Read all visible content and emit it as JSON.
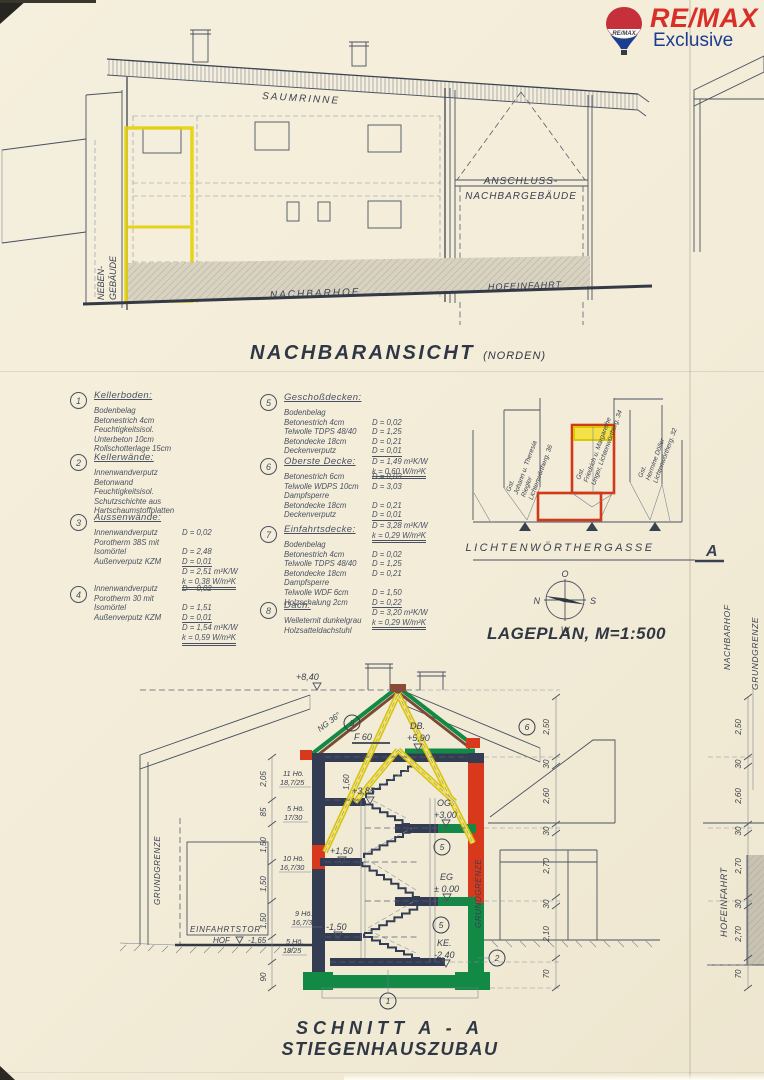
{
  "logo": {
    "brand": "RE/MAX",
    "sub": "Exclusive",
    "balloon_text": "RE/MAX"
  },
  "elevation": {
    "title": "NACHBARANSICHT",
    "title_suffix": "(NORDEN)",
    "labels": {
      "saumrinne": "SAUMRINNE",
      "anschluss1": "ANSCHLUSS-",
      "anschluss2": "NACHBARGEBÄUDE",
      "neben1": "NEBEN-",
      "neben2": "GEBÄUDE",
      "nachbarhof": "NACHBARHOF",
      "hofeinfahrt": "HOFEINFAHRT"
    }
  },
  "legend": {
    "items": [
      {
        "num": "1",
        "title": "Kellerboden:",
        "lines": [
          {
            "l": "Bodenbelag",
            "r": ""
          },
          {
            "l": "Betonestrich 4cm",
            "r": ""
          },
          {
            "l": "Feuchtigkeitsisol.",
            "r": ""
          },
          {
            "l": "Unterbeton 10cm",
            "r": ""
          },
          {
            "l": "Rollschotterlage 15cm",
            "r": ""
          }
        ]
      },
      {
        "num": "2",
        "title": "Kellerwände:",
        "lines": [
          {
            "l": "Innenwandverputz",
            "r": ""
          },
          {
            "l": "Betonwand",
            "r": ""
          },
          {
            "l": "Feuchtigkeitsisol.",
            "r": ""
          },
          {
            "l": "Schutzschichte aus",
            "r": ""
          },
          {
            "l": "Hartschaumstoffplatten",
            "r": ""
          }
        ]
      },
      {
        "num": "3",
        "title": "Aussenwände:",
        "lines": [
          {
            "l": "Innenwandverputz",
            "r": "D = 0,02"
          },
          {
            "l": "Porotherm 38S mit",
            "r": ""
          },
          {
            "l": "Isomörtel",
            "r": "D = 2,48"
          },
          {
            "l": "Außenverputz KZM",
            "r": "D = 0,01",
            "u": 1
          },
          {
            "l": "",
            "r": "D = 2,51 m²K/W"
          },
          {
            "l": "",
            "r": "k = 0,38 W/m²K",
            "u": 2
          }
        ]
      },
      {
        "num": "4",
        "title": "",
        "lines": [
          {
            "l": "Innenwandverputz",
            "r": "D = 0,02"
          },
          {
            "l": "Porotherm 30 mit",
            "r": ""
          },
          {
            "l": "Isomörtel",
            "r": "D = 1,51"
          },
          {
            "l": "Außenverputz KZM",
            "r": "D = 0,01",
            "u": 1
          },
          {
            "l": "",
            "r": "D = 1,54 m²K/W"
          },
          {
            "l": "",
            "r": "k = 0,59 W/m²K",
            "u": 2
          }
        ]
      },
      {
        "num": "5",
        "title": "Geschoßdecken:",
        "lines": [
          {
            "l": "Bodenbelag",
            "r": ""
          },
          {
            "l": "Betonestrich 4cm",
            "r": "D = 0,02"
          },
          {
            "l": "Telwolle TDPS 48/40",
            "r": "D = 1,25"
          },
          {
            "l": "Betondecke 18cm",
            "r": "D = 0,21"
          },
          {
            "l": "Deckenverputz",
            "r": "D = 0,01",
            "u": 1
          },
          {
            "l": "",
            "r": "D = 1,49 m²K/W"
          },
          {
            "l": "",
            "r": "k = 0,60 W/m²K",
            "u": 2
          }
        ]
      },
      {
        "num": "6",
        "title": "Oberste Decke:",
        "lines": [
          {
            "l": "Betonestrich 6cm",
            "r": "D = 0,03"
          },
          {
            "l": "Telwolle WDPS 10cm",
            "r": "D = 3,03"
          },
          {
            "l": "Dampfsperre",
            "r": ""
          },
          {
            "l": "Betondecke 18cm",
            "r": "D = 0,21"
          },
          {
            "l": "Deckenverputz",
            "r": "D = 0,01",
            "u": 1
          },
          {
            "l": "",
            "r": "D = 3,28 m²K/W"
          },
          {
            "l": "",
            "r": "k = 0,29 W/m²K",
            "u": 2
          }
        ]
      },
      {
        "num": "7",
        "title": "Einfahrtsdecke:",
        "lines": [
          {
            "l": "Bodenbelag",
            "r": ""
          },
          {
            "l": "Betonestrich 4cm",
            "r": "D = 0,02"
          },
          {
            "l": "Telwolle TDPS 48/40",
            "r": "D = 1,25"
          },
          {
            "l": "Betondecke 18cm",
            "r": "D = 0,21"
          },
          {
            "l": "Dampfsperre",
            "r": ""
          },
          {
            "l": "Telwolle WDF 6cm",
            "r": "D = 1,50"
          },
          {
            "l": "Holzschalung 2cm",
            "r": "D = 0,22",
            "u": 1
          },
          {
            "l": "",
            "r": "D = 3,20 m²K/W"
          },
          {
            "l": "",
            "r": "k = 0,29 W/m²K",
            "u": 2
          }
        ]
      },
      {
        "num": "8",
        "title": "Dach:",
        "lines": [
          {
            "l": "Welleternit dunkelgrau",
            "r": ""
          },
          {
            "l": "Holzsatteldachstuhl",
            "r": ""
          }
        ]
      }
    ]
  },
  "siteplan": {
    "title": "LAGEPLAN, M=1:500",
    "street": "LICHTENWÖRTHERGASSE",
    "marker": "A",
    "compass": {
      "top": "O",
      "left": "N",
      "right": "S",
      "bottom": "W"
    },
    "parcels": [
      {
        "rows": [
          "Gst.",
          "Johann u. Theresia",
          "Riegler",
          "Lichtenwörtherg. 36"
        ]
      },
      {
        "rows": [
          "Gst.",
          "Friedrich u. Margarethe",
          "Unger, Lichtenwörtherg. 34"
        ]
      },
      {
        "rows": [
          "Gst.",
          "Hermine Döller",
          "Lichtenwörtherg. 32"
        ]
      }
    ]
  },
  "section": {
    "title1": "SCHNITT  A - A",
    "title2": "STIEGENHAUSZUBAU",
    "levels": {
      "ridge": "+8,40",
      "db_label": "DB.",
      "db": "+5,90",
      "p385": "+3,85",
      "og_label": "OG.",
      "og": "+3,00",
      "p150": "+1,50",
      "eg_label": "EG",
      "eg": "± 0.00",
      "m150": "-1,50",
      "ke_label": "KE.",
      "ke": "-2,40",
      "einfahrtstor": "EINFAHRTSTOR",
      "hof_label": "HOF",
      "hof": "-1,65"
    },
    "roof_pitch": "NG 36°",
    "f60": "F 60",
    "dim160": "1,60",
    "stair_notes": [
      {
        "a": "11 Hö.",
        "b": "18,7/25"
      },
      {
        "a": "5 Hö.",
        "b": "17/30"
      },
      {
        "a": "10 Hö.",
        "b": "16,7/30"
      },
      {
        "a": "9 Hö.",
        "b": "16,7/30"
      },
      {
        "a": "5 Hö.",
        "b": "18/25"
      }
    ],
    "left_dims": [
      "2,05",
      "85",
      "1,50",
      "1,50",
      "1,50",
      "90"
    ],
    "mid_dims": [
      "2,50",
      "30",
      "2,60",
      "30",
      "2,70",
      "30",
      "2,10",
      "70"
    ],
    "right_dims": [
      "2,50",
      "30",
      "2,60",
      "30",
      "2,70",
      "30",
      "2,70",
      "70"
    ],
    "grundgrenze": "GRUNDGRENZE",
    "nachbarhof": "NACHBARHOF",
    "hofeinfahrt": "HOFEINFAHRT",
    "circles": {
      "c1": "1",
      "c2": "2",
      "c5": "5",
      "c6": "6",
      "c8": "8"
    }
  }
}
